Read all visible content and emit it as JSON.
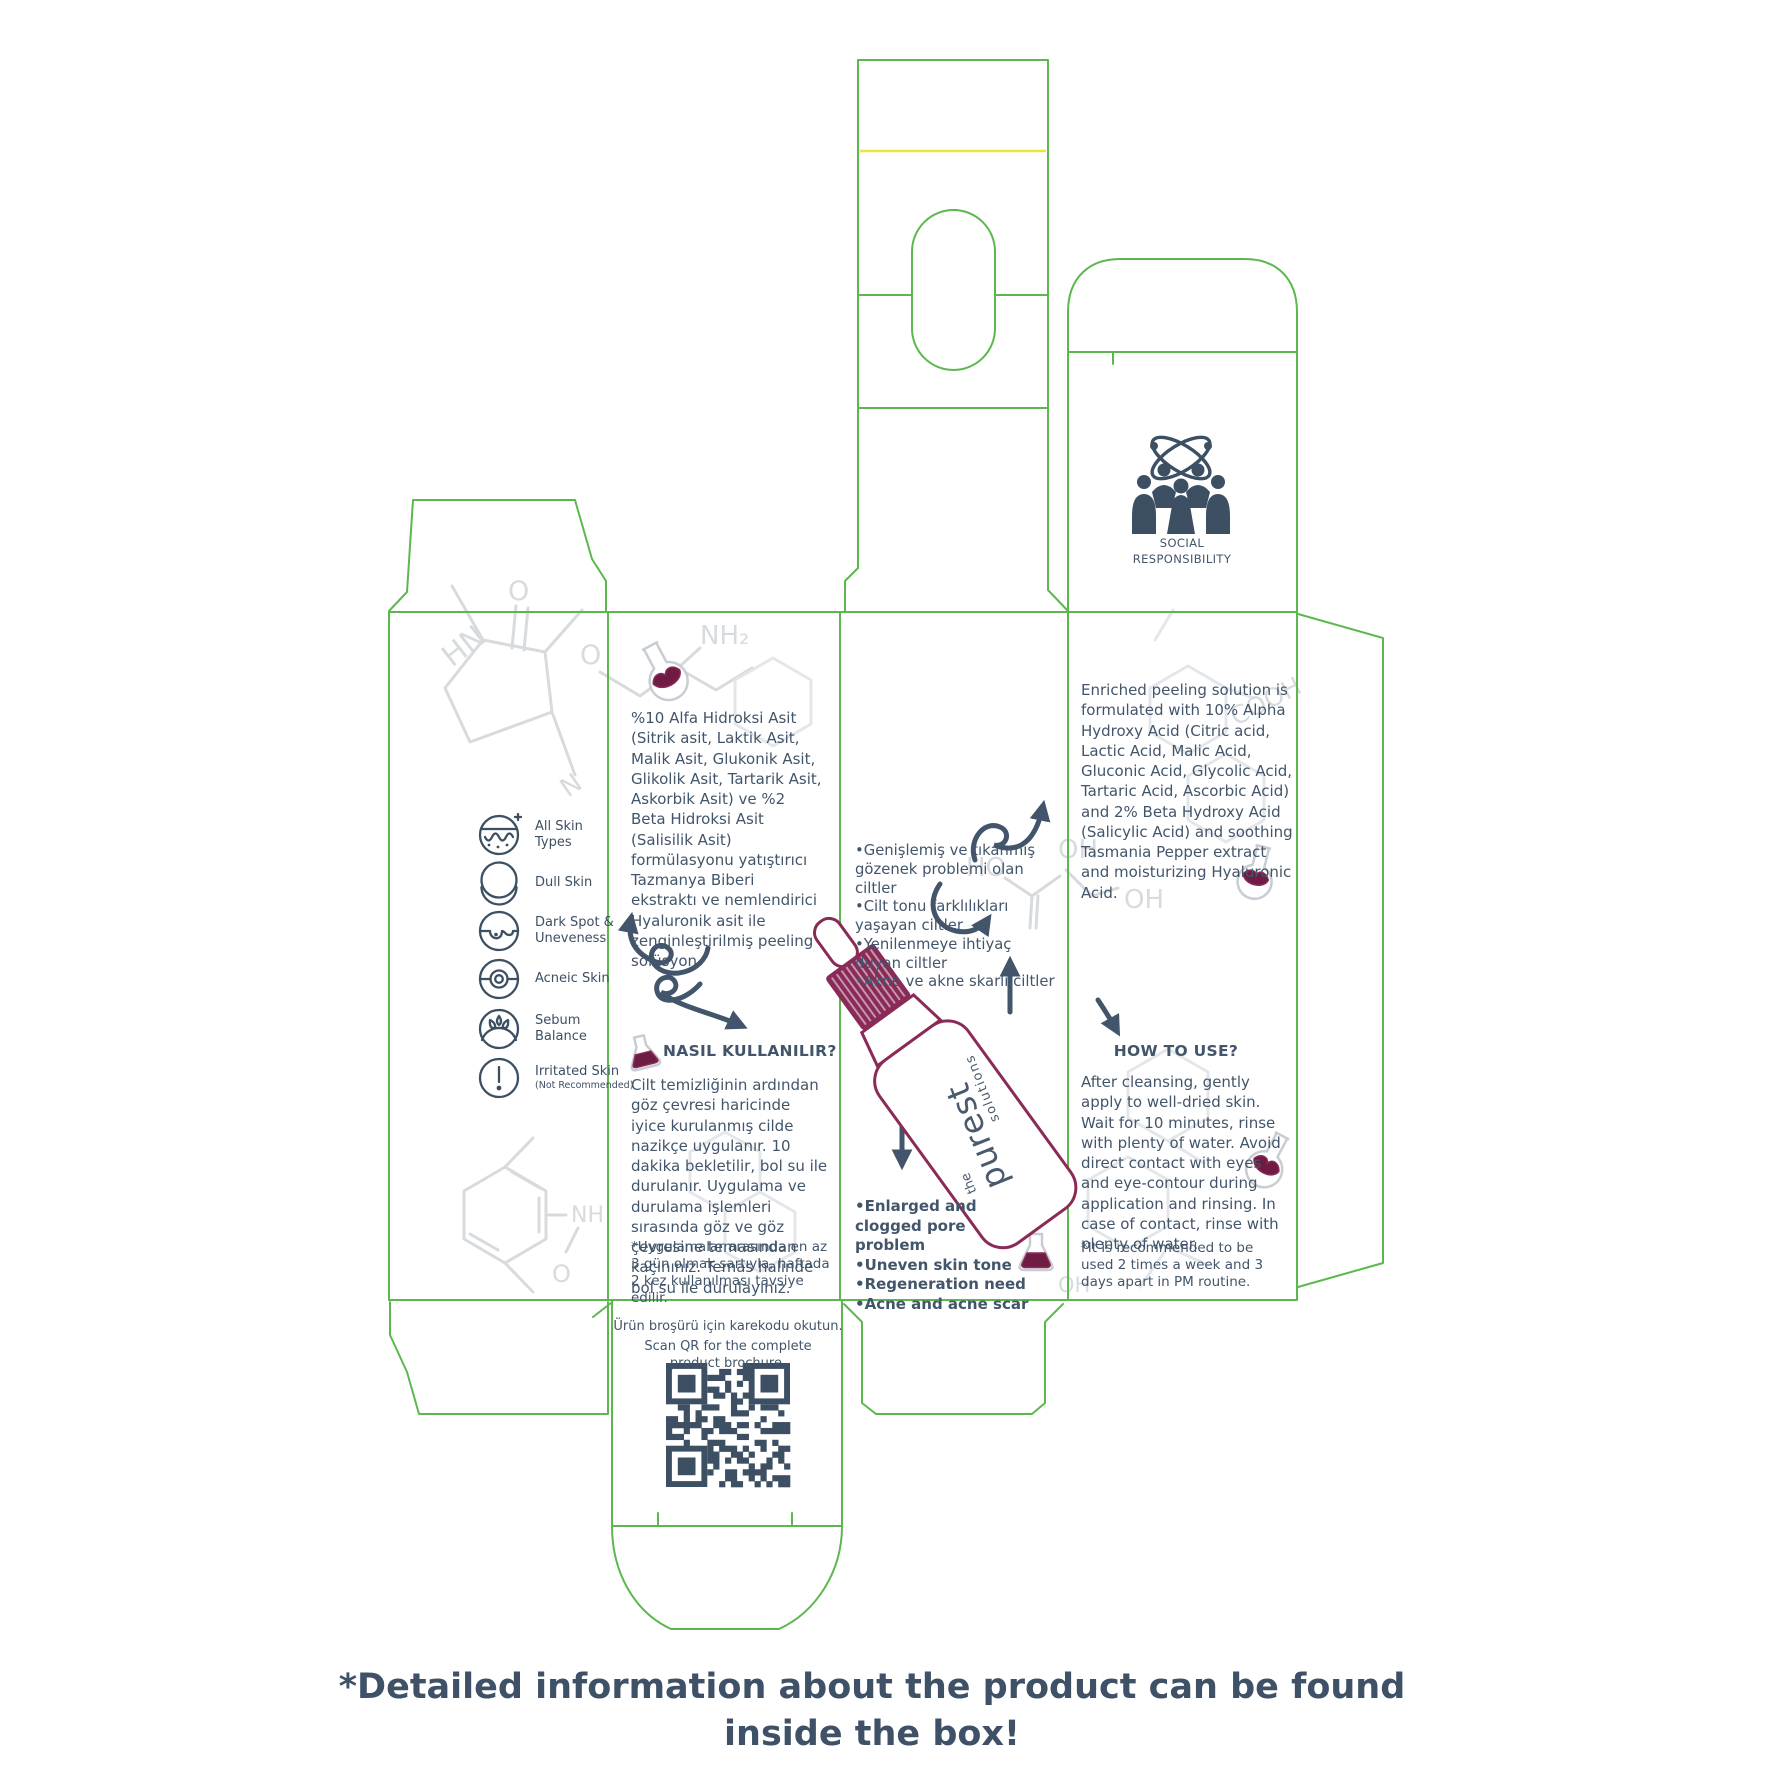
{
  "colors": {
    "dieline_green": "#5cb84e",
    "crease_yellow": "#ebe43d",
    "ink_slate": "#42556a",
    "brand_maroon": "#8a2a57",
    "liquid_maroon": "#6e1c44",
    "molecule_gray": "#d7dbde"
  },
  "brand": {
    "the": "the",
    "name": "purest",
    "sub": "solutions"
  },
  "social": {
    "line1": "SOCIAL",
    "line2": "RESPONSIBILITY"
  },
  "skin_types": {
    "items": [
      {
        "label": "All Skin Types"
      },
      {
        "label": "Dull Skin"
      },
      {
        "label": "Dark Spot & Uneveness"
      },
      {
        "label": "Acneic Skin"
      },
      {
        "label": "Sebum Balance"
      },
      {
        "label": "Irritated Skin",
        "note": "(Not Recommended)"
      }
    ]
  },
  "panel_tr": {
    "description": "%10 Alfa Hidroksi Asit (Sitrik asit, Laktik Asit, Malik Asit, Glukonik Asit, Glikolik Asit, Tartarik Asit, Askorbik Asit) ve %2 Beta Hidroksi Asit (Salisilik Asit) formülasyonu yatıştırıcı Tazmanya Biberi ekstraktı ve nemlendirici Hyaluronik asit ile zenginleştirilmiş peeling solüsyon.",
    "how_title": "NASIL KULLANILIR?",
    "how_text": "Cilt temizliğinin ardından göz çevresi haricinde iyice kurulanmış cilde nazikçe uygulanır. 10 dakika bekletilir, bol su ile durulanır. Uygulama ve durulama işlemleri sırasında göz ve göz çevresine temasından kaçınınız. Temas halinde bol su ile durulayınız.",
    "how_note": "*Uygulamalar arasında en az 3 gün olmak şartıyla, haftada 2 kez kullanılması tavsiye edilir."
  },
  "panel_mid": {
    "bullets_tr": [
      "•Genişlemiş ve tıkanmış gözenek problemi olan ciltler",
      "•Cilt tonu farklılıkları yaşayan ciltler",
      "•Yenilenmeye ihtiyaç duyan ciltler",
      "•Akne ve akne skarlı ciltler"
    ],
    "bullets_en": [
      "•Enlarged and clogged pore problem",
      "•Uneven skin tone",
      "•Regeneration need",
      "•Acne and acne scar"
    ]
  },
  "panel_en": {
    "description": "Enriched peeling solution is formulated with 10% Alpha Hydroxy Acid (Citric acid, Lactic Acid, Malic Acid, Gluconic Acid, Glycolic Acid, Tartaric Acid, Ascorbic Acid) and 2% Beta Hydroxy Acid (Salicylic Acid) and soothing Tasmania Pepper extract and moisturizing Hyaluronic Acid.",
    "how_title": "HOW TO USE?",
    "how_text": "After cleansing, gently apply to well-dried skin. Wait for 10 minutes, rinse with plenty of water. Avoid direct contact with eyes and eye-contour during application and rinsing. In case of contact, rinse with plenty of water.",
    "how_note": "*It is recommended to be used 2 times a week and 3 days apart in PM routine."
  },
  "qr": {
    "line_tr": "Ürün broşürü için karekodu okutun.",
    "line_en": "Scan QR for the complete product brochure."
  },
  "molecule_labels": {
    "hn": "HN",
    "n": "N",
    "o": "O",
    "nh2": "NH₂",
    "cooh": "COOH",
    "ho": "HO",
    "oh": "OH"
  },
  "page": {
    "footer_note": "*Detailed information about the product can be found inside the box!"
  }
}
